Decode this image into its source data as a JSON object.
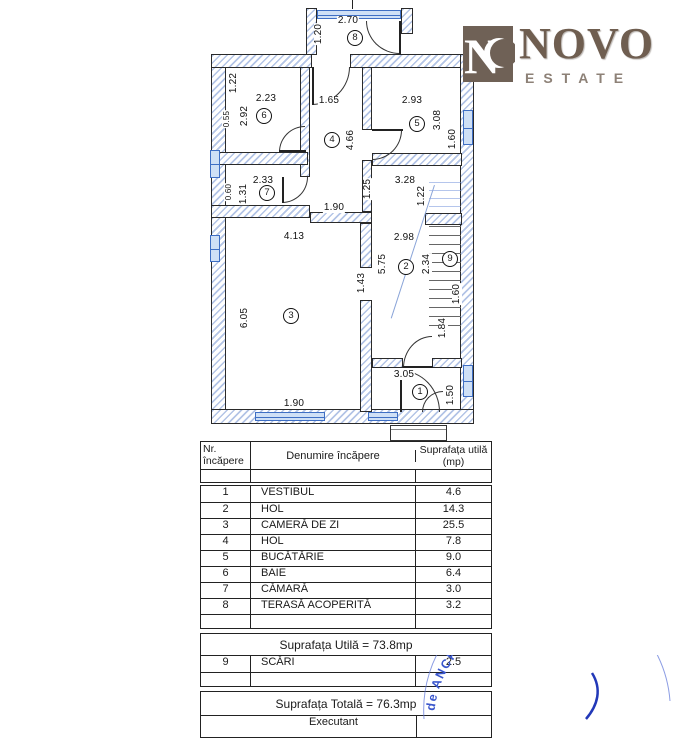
{
  "logo": {
    "mark": "N",
    "name": "NOVO",
    "sub": "ESTATE"
  },
  "colors": {
    "wall_hatch": "#b3c4e6",
    "window": "#3f6fc4",
    "logo_bg": "#6f6156",
    "logo_text": "#6f5e50",
    "logo_sub": "#8d8177",
    "stamp_blue": "#3a56cc"
  },
  "plan": {
    "room_numbers": [
      "1",
      "2",
      "3",
      "4",
      "5",
      "6",
      "7",
      "8",
      "9"
    ],
    "dims": {
      "terrace_w": "2.70",
      "terrace_h": "1.20",
      "r6_top": "1.22",
      "r6_w": "2.23",
      "r6_h": "2.92",
      "r6_win": "0.55",
      "r4_w": "1.65",
      "r4_h": "4.66",
      "r5_w": "2.93",
      "r5_h": "3.08",
      "r5_win": "1.60",
      "r7_w": "2.33",
      "r7_h": "1.31",
      "r7_win": "0.60",
      "corridor": "1.90",
      "r2_off": "1.25",
      "r2_top": "3.28",
      "stair_top": "1.22",
      "r2_w": "2.98",
      "r2_h": "5.75",
      "stair_h": "2.34",
      "r9_win": "1.60",
      "r1_off": "1.84",
      "r3_w": "4.13",
      "r3_h": "6.05",
      "r3_pass": "1.43",
      "r3_win": "1.90",
      "r1_w": "3.05",
      "r1_h": "1.50"
    }
  },
  "table": {
    "headers": [
      "Nr. încăpere",
      "Denumire încăpere",
      "Suprafața utilă (mp)"
    ],
    "rows": [
      {
        "nr": "1",
        "name": "VESTIBUL",
        "area": "4.6"
      },
      {
        "nr": "2",
        "name": "HOL",
        "area": "14.3"
      },
      {
        "nr": "3",
        "name": "CAMERĂ DE ZI",
        "area": "25.5"
      },
      {
        "nr": "4",
        "name": "HOL",
        "area": "7.8"
      },
      {
        "nr": "5",
        "name": "BUCĂTĂRIE",
        "area": "9.0"
      },
      {
        "nr": "6",
        "name": "BAIE",
        "area": "6.4"
      },
      {
        "nr": "7",
        "name": "CĂMARĂ",
        "area": "3.0"
      },
      {
        "nr": "8",
        "name": "TERASĂ ACOPERITĂ",
        "area": "3.2"
      }
    ],
    "subtotal": "Suprafața Utilă = 73.8mp",
    "stairs_row": {
      "nr": "9",
      "name": "SCĂRI",
      "area": "2.5"
    },
    "total": "Suprafața Totală = 76.3mp",
    "executant": "Executant"
  },
  "stamp": {
    "arc_text": "de ANCPI să execute luc"
  }
}
